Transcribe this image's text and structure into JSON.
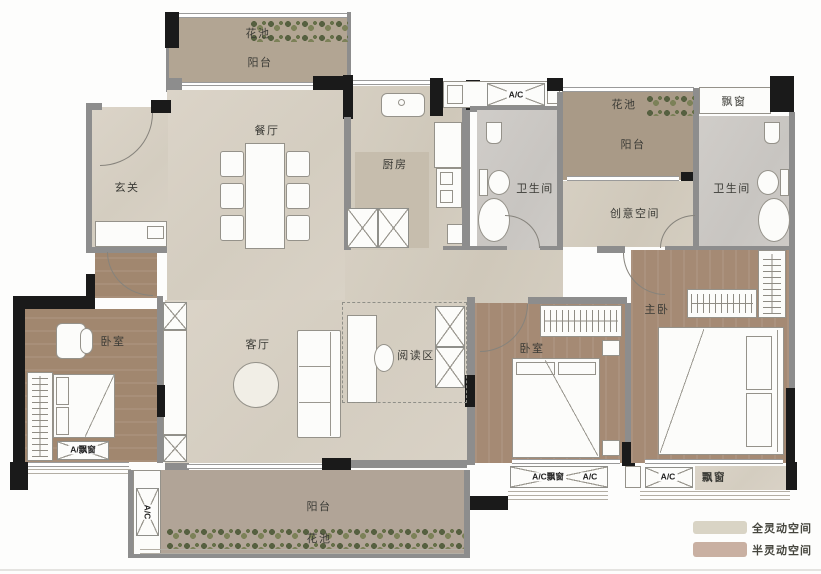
{
  "labels": {
    "flower_tl": "花池",
    "balcony_tl": "阳台",
    "dining": "餐厅",
    "foyer": "玄关",
    "kitchen": "厨房",
    "ac_top": "A/C",
    "bath_left": "卫生间",
    "flower_tr": "花池",
    "balcony_tr": "阳台",
    "bay_tr": "飘窗",
    "bath_right": "卫生间",
    "creative": "创意空间",
    "living": "客厅",
    "reading": "阅读区",
    "bedroom_left": "卧室",
    "bedroom_mid": "卧室",
    "master": "主卧",
    "bay_left": "A/飘窗",
    "ac_left": "A/C",
    "balcony_bottom": "阳台",
    "flower_bottom": "花池",
    "bay_mid": "A/C飘窗",
    "ac_mid": "A/C",
    "ac_right": "A/C",
    "bay_br": "飘窗"
  },
  "legend": {
    "items": [
      {
        "label": "全灵动空间",
        "color": "#d9d4c5"
      },
      {
        "label": "半灵动空间",
        "color": "#c9b0a2"
      }
    ]
  }
}
